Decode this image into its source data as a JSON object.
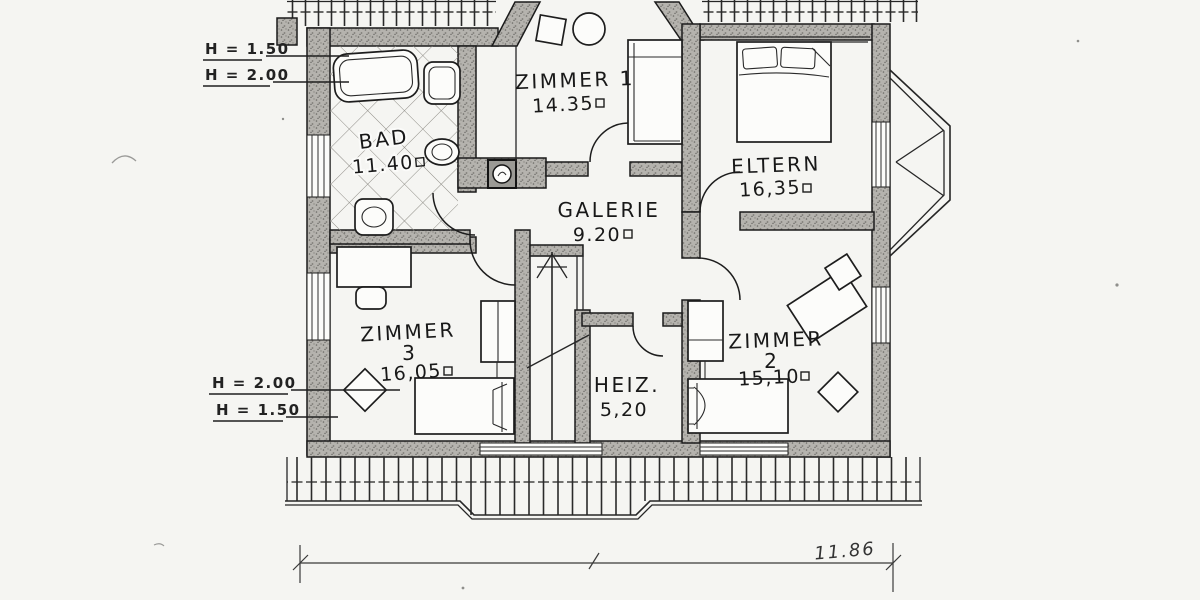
{
  "plan": {
    "rooms": {
      "bad": {
        "name": "BAD",
        "area": "11.40"
      },
      "zimmer1": {
        "name": "ZIMMER 1",
        "area": "14.35"
      },
      "eltern": {
        "name": "ELTERN",
        "area": "16,35"
      },
      "galerie": {
        "name": "GALERIE",
        "area": "9.20"
      },
      "zimmer3": {
        "name": "ZIMMER",
        "number": "3",
        "area": "16,05"
      },
      "heiz": {
        "name": "HEIZ.",
        "area": "5,20"
      },
      "zimmer2": {
        "name": "ZIMMER",
        "number": "2",
        "area": "15,10"
      }
    },
    "height_marks": {
      "top_1": "H = 1.50",
      "top_2": "H = 2.00",
      "bottom_1": "H = 2.00",
      "bottom_2": "H = 1.50"
    },
    "dimension_total": "11.86"
  },
  "colors": {
    "ink": "#1f1f1f",
    "paper": "#f5f5f2",
    "wall_fill": "#b5b3ae"
  }
}
